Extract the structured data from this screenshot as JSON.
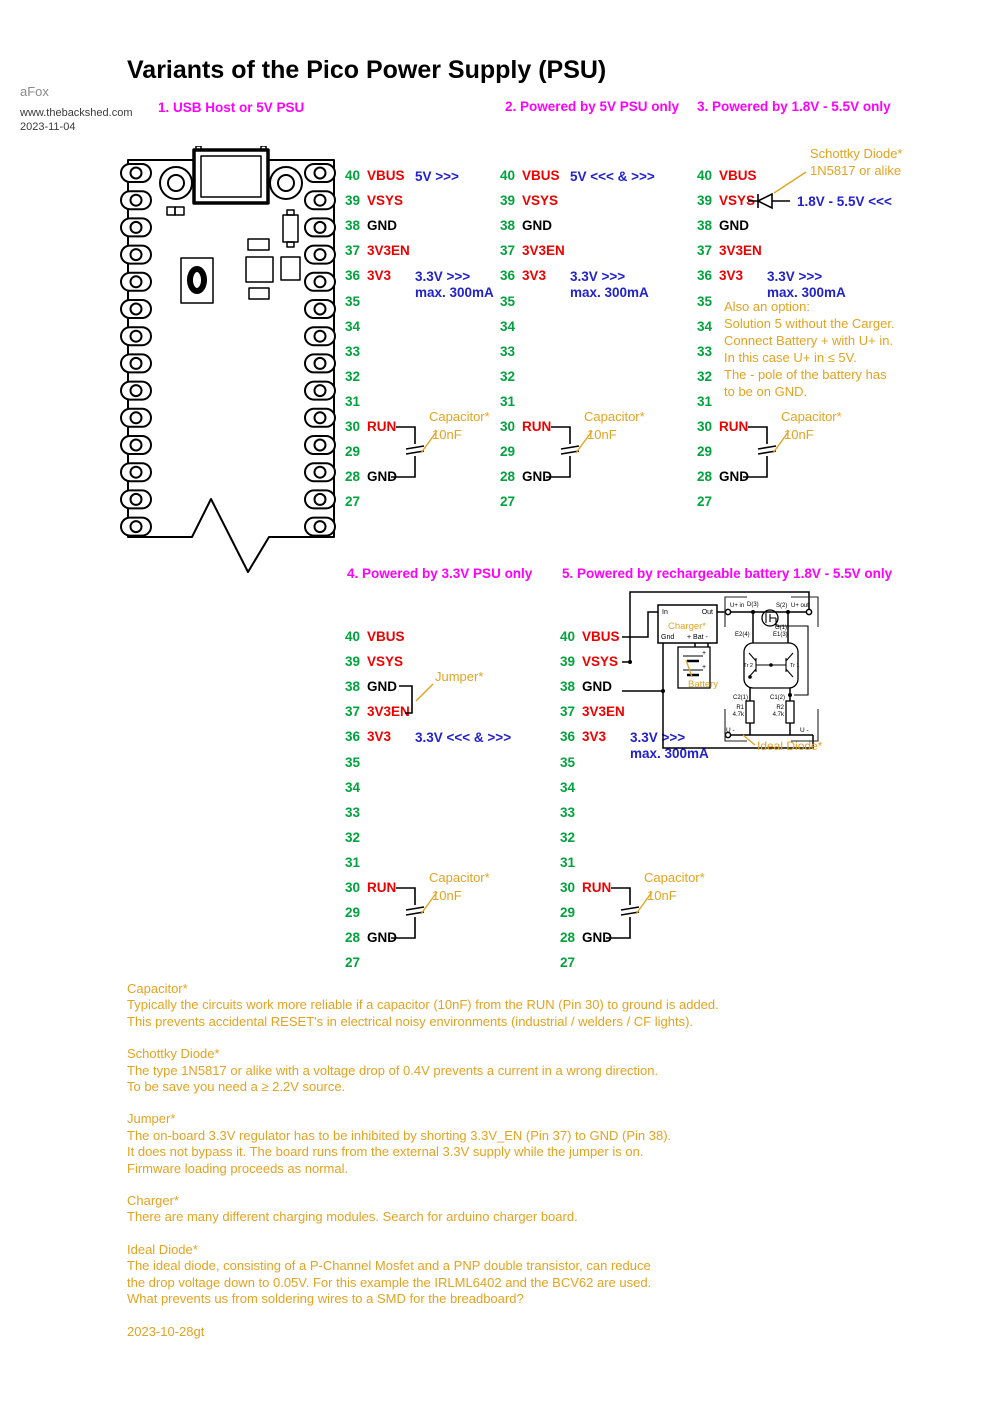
{
  "title": "Variants of the Pico Power Supply (PSU)",
  "byline": {
    "author": "aFox",
    "website": "www.thebackshed.com",
    "date": "2023-11-04"
  },
  "colors": {
    "pin_number_green": "#00A33C",
    "pin_label_red": "#EE0000",
    "annotation_blue": "#2222CC",
    "heading_magenta": "#FF00FF",
    "note_orange": "#E2A321"
  },
  "pins": [
    {
      "num": "40",
      "label": "VBUS",
      "color": "red"
    },
    {
      "num": "39",
      "label": "VSYS",
      "color": "red"
    },
    {
      "num": "38",
      "label": "GND",
      "color": "black"
    },
    {
      "num": "37",
      "label": "3V3EN",
      "color": "red"
    },
    {
      "num": "36",
      "label": "3V3",
      "color": "red"
    },
    {
      "num": "35"
    },
    {
      "num": "34"
    },
    {
      "num": "33"
    },
    {
      "num": "32"
    },
    {
      "num": "31"
    },
    {
      "num": "30",
      "label": "RUN",
      "color": "red"
    },
    {
      "num": "29"
    },
    {
      "num": "28",
      "label": "GND",
      "color": "black"
    },
    {
      "num": "27"
    }
  ],
  "variants": [
    {
      "title": "1. USB Host or 5V PSU",
      "annotations": [
        {
          "pin": "40",
          "lines": [
            "5V >>>"
          ]
        },
        {
          "pin": "36",
          "lines": [
            "3.3V >>>",
            "max. 300mA"
          ]
        }
      ],
      "capacitor": {
        "label": "Capacitor*",
        "value": "10nF"
      }
    },
    {
      "title": "2. Powered by 5V PSU only",
      "annotations": [
        {
          "pin": "40",
          "lines": [
            "5V <<< & >>>"
          ]
        },
        {
          "pin": "36",
          "lines": [
            "3.3V >>>",
            "max. 300mA"
          ]
        }
      ],
      "capacitor": {
        "label": "Capacitor*",
        "value": "10nF"
      }
    },
    {
      "title": "3. Powered by 1.8V - 5.5V only",
      "annotations": [
        {
          "pin": "36",
          "lines": [
            "3.3V >>>",
            "max. 300mA"
          ]
        }
      ],
      "capacitor": {
        "label": "Capacitor*",
        "value": "10nF"
      },
      "diode": {
        "label_line1": "Schottky Diode*",
        "label_line2": "1N5817 or alike",
        "annotation": "1.8V - 5.5V <<<"
      },
      "option_note": [
        "Also an option:",
        "Solution 5 without the Carger.",
        "Connect Battery + with U+ in.",
        "In this case U+ in ≤ 5V.",
        "The - pole of the battery has",
        "to be on GND."
      ]
    },
    {
      "title": "4. Powered by 3.3V PSU only",
      "annotations": [
        {
          "pin": "36",
          "lines": [
            "3.3V <<< & >>>"
          ]
        }
      ],
      "capacitor": {
        "label": "Capacitor*",
        "value": "10nF"
      },
      "jumper": {
        "label": "Jumper*"
      }
    },
    {
      "title": "5. Powered by rechargeable battery 1.8V - 5.5V only",
      "annotations": [
        {
          "pin": "36",
          "lines": [
            "3.3V >>>",
            "max. 300mA"
          ]
        }
      ],
      "capacitor": {
        "label": "Capacitor*",
        "value": "10nF"
      },
      "circuit": {
        "charger": {
          "in": "In",
          "out": "Out",
          "label": "Charger*",
          "gnd": "Gnd",
          "bat": "+ Bat -"
        },
        "battery": {
          "label": "Battery",
          "plus_top": "+",
          "plus_bottom": "+"
        },
        "ideal_diode": {
          "label": "Ideal Diode*",
          "u_in": "U+ in",
          "d3": "D(3)",
          "s2": "S(2)",
          "u_out": "U+ out",
          "g1": "G(1)",
          "e2": "E2(4)",
          "e1": "E1(3)",
          "tr2": "Tr 2",
          "tr1": "Tr 1",
          "c2": "C2(1)",
          "c1": "C1(2)",
          "r1": "R1",
          "r1_value": "4.7k",
          "r2": "R2",
          "r2_value": "4.7k",
          "u_minus_left": "U -",
          "u_minus_right": "U -"
        }
      }
    }
  ],
  "notes": [
    {
      "title": "Capacitor*",
      "lines": [
        "Typically the circuits work more reliable if a capacitor (10nF) from the RUN (Pin 30) to ground is added.",
        "This prevents accidental RESET's in electrical noisy environments (industrial / welders / CF lights)."
      ]
    },
    {
      "title": "Schottky Diode*",
      "lines": [
        "The type 1N5817 or alike with a voltage drop of 0.4V prevents a current in a wrong direction.",
        "To be save you need a ≥ 2.2V source."
      ]
    },
    {
      "title": "Jumper*",
      "lines": [
        "The on-board 3.3V regulator has to be inhibited by shorting 3.3V_EN (Pin 37) to GND (Pin 38).",
        "It does not bypass it. The board runs from the external 3.3V supply while the jumper is on.",
        "Firmware loading proceeds as normal."
      ]
    },
    {
      "title": "Charger*",
      "lines": [
        "There are many different charging modules. Search for arduino charger board."
      ]
    },
    {
      "title": "Ideal Diode*",
      "lines": [
        "The ideal diode, consisting of a P-Channel Mosfet and a PNP double transistor, can reduce",
        "the drop voltage down to 0.05V. For this example the IRLML6402 and the BCV62 are used.",
        "What prevents us from soldering wires to a SMD for the breadboard?"
      ]
    }
  ],
  "footer_date": "2023-10-28gt"
}
